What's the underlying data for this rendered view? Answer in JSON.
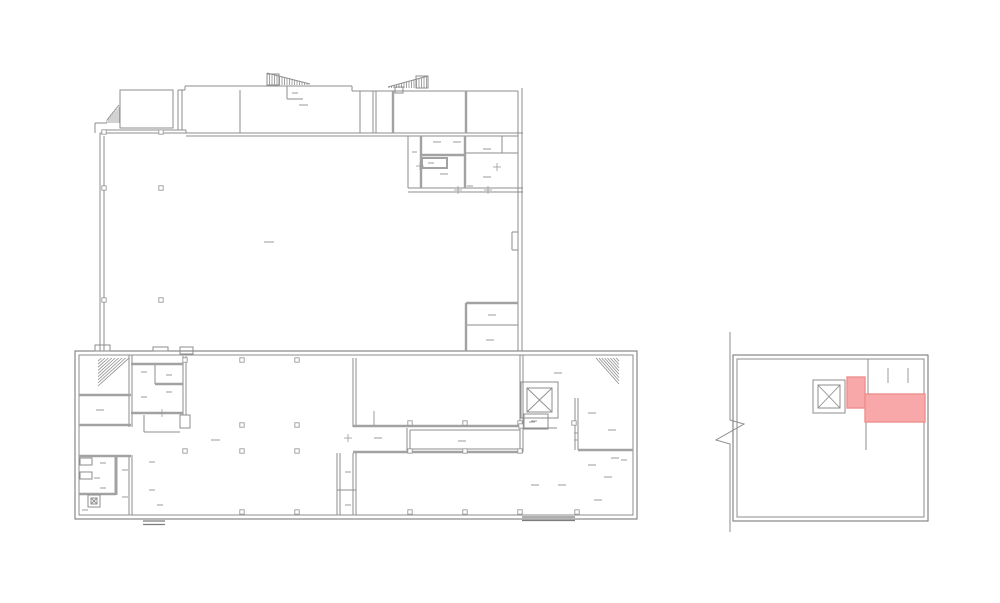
{
  "canvas": {
    "width": 1000,
    "height": 603,
    "background": "#ffffff"
  },
  "palette": {
    "line": "#8e8e8e",
    "wall": "#a2a2a2",
    "dark": "#7c7c7c",
    "mark": "#9b9b9b",
    "highlight_fill": "#f8a8a8",
    "highlight_stroke": "#ee9090",
    "bg": "#ffffff"
  },
  "plans": [
    {
      "name": "main-floor-plan",
      "drects": [
        [
          75,
          351,
          562,
          168,
          4
        ]
      ],
      "lines": [
        [
          185,
          86,
          352,
          86
        ],
        [
          352,
          86,
          352,
          91
        ],
        [
          352,
          91,
          518,
          91
        ],
        [
          185,
          86,
          185,
          90
        ],
        [
          178,
          90,
          185,
          90
        ],
        [
          178,
          90,
          178,
          130
        ],
        [
          182,
          90,
          182,
          130
        ],
        [
          104,
          130,
          186,
          130
        ],
        [
          100,
          133,
          186,
          133
        ],
        [
          186,
          130,
          186,
          133
        ],
        [
          186,
          133,
          523,
          133
        ],
        [
          186,
          136,
          518,
          136
        ],
        [
          100,
          133,
          100,
          351
        ],
        [
          104,
          136,
          104,
          351
        ],
        [
          518,
          91,
          518,
          351
        ],
        [
          522,
          88,
          522,
          351
        ],
        [
          512,
          232,
          518,
          232
        ],
        [
          512,
          250,
          518,
          250
        ],
        [
          512,
          232,
          512,
          250
        ],
        [
          95,
          123,
          107,
          123
        ],
        [
          95,
          123,
          95,
          133
        ],
        [
          240,
          90,
          240,
          133
        ],
        [
          360,
          91,
          360,
          133
        ],
        [
          373,
          91,
          373,
          133
        ],
        [
          376,
          91,
          376,
          133
        ],
        [
          287,
          86,
          287,
          99
        ],
        [
          287,
          99,
          303,
          99
        ],
        [
          408,
          136,
          408,
          188
        ],
        [
          466,
          153,
          518,
          153
        ],
        [
          502,
          136,
          502,
          153
        ],
        [
          408,
          188,
          523,
          188
        ],
        [
          408,
          192,
          523,
          192
        ],
        [
          466,
          325,
          518,
          325
        ],
        [
          129,
          355,
          129,
          427
        ],
        [
          132,
          355,
          132,
          427
        ],
        [
          183,
          356,
          183,
          415
        ],
        [
          186,
          356,
          186,
          415
        ],
        [
          155,
          364,
          155,
          384
        ],
        [
          144,
          415,
          144,
          432
        ],
        [
          144,
          432,
          180,
          432
        ],
        [
          129,
          455,
          129,
          515
        ],
        [
          132,
          455,
          132,
          515
        ],
        [
          353,
          358,
          353,
          427
        ],
        [
          356,
          358,
          356,
          427
        ],
        [
          353,
          453,
          353,
          515
        ],
        [
          356,
          453,
          356,
          515
        ],
        [
          337,
          453,
          337,
          515
        ],
        [
          340,
          453,
          340,
          515
        ],
        [
          337,
          490,
          356,
          490
        ],
        [
          407,
          428,
          407,
          452
        ],
        [
          410,
          430,
          520,
          430
        ],
        [
          410,
          449,
          520,
          449
        ],
        [
          410,
          430,
          410,
          449
        ],
        [
          520,
          355,
          520,
          452
        ],
        [
          523,
          355,
          523,
          452
        ],
        [
          523,
          428,
          557,
          428
        ],
        [
          575,
          398,
          575,
          450
        ],
        [
          578,
          398,
          578,
          450
        ],
        [
          267,
          73,
          310,
          84
        ],
        [
          388,
          87,
          428,
          76
        ],
        [
          107,
          120,
          119,
          105
        ]
      ],
      "walls": [
        [
          393,
          91,
          393,
          133
        ],
        [
          466,
          91,
          466,
          133
        ],
        [
          421,
          136,
          421,
          188
        ],
        [
          465,
          136,
          465,
          188
        ],
        [
          421,
          155,
          465,
          155
        ],
        [
          466,
          303,
          466,
          351
        ],
        [
          466,
          303,
          518,
          303
        ],
        [
          79,
          395,
          131,
          395
        ],
        [
          79,
          425,
          131,
          425
        ],
        [
          131,
          364,
          183,
          364
        ],
        [
          155,
          384,
          183,
          384
        ],
        [
          131,
          413,
          183,
          413
        ],
        [
          79,
          456,
          131,
          456
        ],
        [
          116,
          456,
          116,
          495,
          3
        ],
        [
          79,
          494,
          116,
          494
        ],
        [
          353,
          426,
          523,
          426
        ],
        [
          353,
          452,
          523,
          452
        ],
        [
          578,
          450,
          633,
          450
        ]
      ],
      "rects": [
        [
          120,
          90,
          53,
          38
        ],
        [
          422,
          158,
          25,
          10,
          2,
          1
        ],
        [
          524,
          414,
          24,
          15
        ],
        [
          80,
          458,
          12,
          7
        ],
        [
          80,
          472,
          12,
          7
        ],
        [
          267,
          74,
          12,
          11
        ],
        [
          416,
          76,
          12,
          12
        ],
        [
          395,
          87,
          8,
          6
        ],
        [
          95,
          345,
          15,
          6
        ],
        [
          153,
          347,
          15,
          4
        ],
        [
          180,
          347,
          13,
          7
        ],
        [
          180,
          415,
          10,
          13
        ]
      ],
      "doors": [
        [
          143,
          521,
          22
        ],
        [
          522,
          517,
          53
        ]
      ],
      "xboxes": [
        [
          521,
          382,
          37,
          36,
          6
        ],
        [
          88,
          495,
          12,
          12,
          3
        ]
      ],
      "vtris": [
        [
          267,
          309,
          85,
          12,
          1,
          2.5
        ],
        [
          389,
          428,
          88,
          1,
          12,
          2.5
        ],
        [
          107,
          119,
          123,
          3,
          16,
          2
        ]
      ],
      "dtris": [
        [
          98,
          358,
          31,
          28,
          0,
          9
        ],
        [
          596,
          358,
          23,
          26,
          1,
          8
        ]
      ],
      "cols": [
        [
          104,
          132
        ],
        [
          161,
          132
        ],
        [
          104,
          188
        ],
        [
          161,
          188
        ],
        [
          104,
          300
        ],
        [
          161,
          300
        ],
        [
          185,
          360
        ],
        [
          242,
          360
        ],
        [
          297,
          360
        ],
        [
          242,
          425
        ],
        [
          297,
          425
        ],
        [
          410,
          423
        ],
        [
          465,
          423
        ],
        [
          520,
          423
        ],
        [
          185,
          451
        ],
        [
          242,
          451
        ],
        [
          297,
          451
        ],
        [
          410,
          451
        ],
        [
          465,
          451
        ],
        [
          520,
          451
        ],
        [
          242,
          512
        ],
        [
          297,
          512
        ],
        [
          410,
          512
        ],
        [
          465,
          512
        ],
        [
          520,
          512
        ],
        [
          577,
          512
        ],
        [
          521,
          426
        ],
        [
          574,
          423
        ]
      ],
      "crosses": [
        [
          458,
          190
        ],
        [
          488,
          190
        ],
        [
          420,
          166
        ],
        [
          497,
          167
        ],
        [
          162,
          413
        ],
        [
          348,
          438
        ]
      ],
      "vticks": [
        [
          374,
          411,
          14
        ]
      ],
      "dashes": [
        [
          299,
          105,
          9
        ],
        [
          292,
          93,
          6
        ],
        [
          264,
          242,
          10
        ],
        [
          433,
          142,
          8
        ],
        [
          453,
          142,
          8
        ],
        [
          483,
          149,
          8
        ],
        [
          412,
          152,
          5
        ],
        [
          428,
          163,
          6
        ],
        [
          440,
          174,
          8
        ],
        [
          483,
          177,
          8
        ],
        [
          467,
          186,
          6
        ],
        [
          488,
          315,
          8
        ],
        [
          486,
          340,
          8
        ],
        [
          96,
          410,
          8
        ],
        [
          141,
          372,
          6
        ],
        [
          166,
          375,
          6
        ],
        [
          141,
          397,
          6
        ],
        [
          166,
          392,
          6
        ],
        [
          211,
          440,
          9
        ],
        [
          374,
          438,
          8
        ],
        [
          458,
          441,
          8
        ],
        [
          531,
          421,
          6
        ],
        [
          100,
          463,
          6
        ],
        [
          94,
          478,
          6
        ],
        [
          100,
          488,
          6
        ],
        [
          82,
          510,
          6
        ],
        [
          122,
          470,
          6
        ],
        [
          122,
          497,
          6
        ],
        [
          149,
          462,
          6
        ],
        [
          149,
          490,
          6
        ],
        [
          157,
          505,
          6
        ],
        [
          345,
          472,
          6
        ],
        [
          345,
          505,
          6
        ],
        [
          554,
          373,
          8
        ],
        [
          529,
          422,
          6
        ],
        [
          588,
          413,
          8
        ],
        [
          608,
          430,
          8
        ],
        [
          611,
          458,
          8
        ],
        [
          588,
          465,
          8
        ],
        [
          604,
          477,
          8
        ],
        [
          531,
          485,
          8
        ],
        [
          558,
          485,
          8
        ],
        [
          594,
          500,
          8
        ],
        [
          621,
          460,
          6
        ],
        [
          574,
          433,
          4
        ],
        [
          574,
          440,
          4
        ]
      ]
    },
    {
      "name": "detail-floor-plan",
      "drects": [
        [
          733,
          355,
          195,
          166,
          4
        ]
      ],
      "lines": [
        [
          868,
          359,
          868,
          394
        ],
        [
          868,
          394,
          924,
          394
        ],
        [
          866,
          422,
          866,
          450
        ]
      ],
      "vticks": [
        [
          888,
          368,
          15
        ],
        [
          908,
          368,
          15
        ]
      ],
      "xboxes": [
        [
          813,
          380,
          32,
          33,
          5
        ]
      ],
      "highlights": [
        [
          847,
          377,
          18,
          31
        ],
        [
          865,
          394,
          60,
          28
        ]
      ],
      "breaks": [
        "730,332 730,420 744,424 716,440 730,444 730,532"
      ]
    }
  ]
}
